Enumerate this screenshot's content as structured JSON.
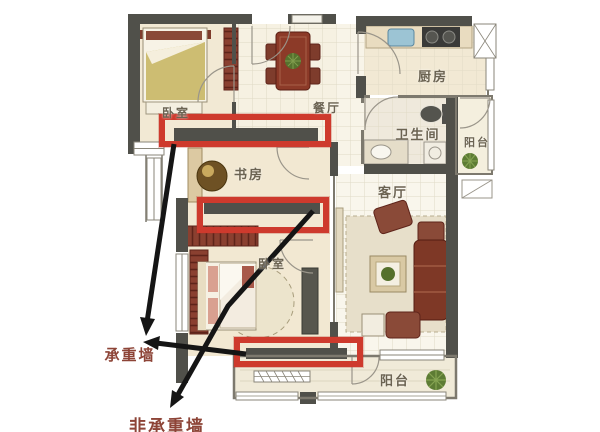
{
  "diagram": {
    "type": "apartment-floor-plan"
  },
  "rooms": {
    "bedroom_top": {
      "label": "卧室"
    },
    "dining": {
      "label": "餐厅"
    },
    "kitchen": {
      "label": "厨房"
    },
    "bathroom": {
      "label": "卫生间"
    },
    "balcony_right": {
      "label": "阳台"
    },
    "living": {
      "label": "客厅"
    },
    "study": {
      "label": "书房"
    },
    "bedroom_bottom": {
      "label": "卧室"
    },
    "balcony_bottom": {
      "label": "阳台"
    }
  },
  "annotations": {
    "load_bearing_wall": {
      "label": "承重墙"
    },
    "non_load_bearing_wall": {
      "label": "非承重墙"
    }
  },
  "colors": {
    "highlight_red": "#ce3a2d",
    "wall_dark": "#50504a",
    "annotation_text": "#8d4437",
    "room_text": "#6b6352",
    "floor_cream": "#f2e9d4",
    "furniture_red": "#8a4030"
  }
}
